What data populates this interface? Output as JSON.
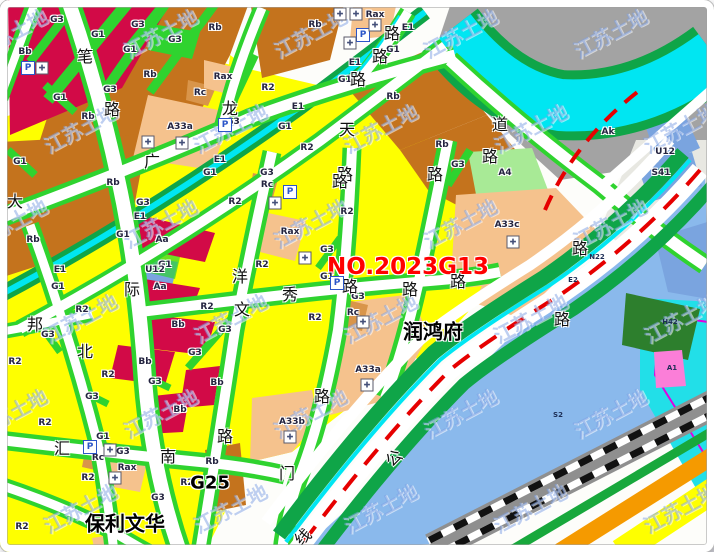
{
  "map": {
    "lot_label": {
      "text": "NO.2023G13",
      "x": 408,
      "y": 267,
      "color": "#ff0000"
    },
    "landmarks": [
      {
        "text": "润鸿府",
        "x": 433,
        "y": 330,
        "style": "poi"
      },
      {
        "text": "G25",
        "x": 210,
        "y": 483,
        "style": "poi-small"
      },
      {
        "text": "保利文华",
        "x": 125,
        "y": 522,
        "style": "poi"
      }
    ],
    "watermark": {
      "text": "江苏土地"
    },
    "street_chars": [
      {
        "t": "笔",
        "x": 85,
        "y": 55
      },
      {
        "t": "路",
        "x": 112,
        "y": 108
      },
      {
        "t": "广",
        "x": 152,
        "y": 160
      },
      {
        "t": "龙",
        "x": 230,
        "y": 107
      },
      {
        "t": "天",
        "x": 347,
        "y": 128
      },
      {
        "t": "道",
        "x": 500,
        "y": 123
      },
      {
        "t": "路",
        "x": 490,
        "y": 155
      },
      {
        "t": "路",
        "x": 392,
        "y": 32
      },
      {
        "t": "路",
        "x": 380,
        "y": 55
      },
      {
        "t": "路",
        "x": 358,
        "y": 78
      },
      {
        "t": "路",
        "x": 345,
        "y": 173
      },
      {
        "t": "路",
        "x": 435,
        "y": 173
      },
      {
        "t": "大",
        "x": 15,
        "y": 200
      },
      {
        "t": "际",
        "x": 132,
        "y": 288
      },
      {
        "t": "邦",
        "x": 35,
        "y": 323
      },
      {
        "t": "北",
        "x": 85,
        "y": 350
      },
      {
        "t": "洋",
        "x": 240,
        "y": 275
      },
      {
        "t": "文",
        "x": 242,
        "y": 308
      },
      {
        "t": "秀",
        "x": 290,
        "y": 293
      },
      {
        "t": "路",
        "x": 350,
        "y": 285
      },
      {
        "t": "路",
        "x": 410,
        "y": 288
      },
      {
        "t": "路",
        "x": 458,
        "y": 280
      },
      {
        "t": "路",
        "x": 340,
        "y": 180
      },
      {
        "t": "路",
        "x": 580,
        "y": 247
      },
      {
        "t": "路",
        "x": 562,
        "y": 318
      },
      {
        "t": "汇",
        "x": 62,
        "y": 447
      },
      {
        "t": "南",
        "x": 168,
        "y": 455
      },
      {
        "t": "路",
        "x": 225,
        "y": 435
      },
      {
        "t": "路",
        "x": 322,
        "y": 395
      },
      {
        "t": "门",
        "x": 287,
        "y": 472
      },
      {
        "t": "公",
        "x": 393,
        "y": 457,
        "r": 1
      },
      {
        "t": "线",
        "x": 302,
        "y": 536,
        "r": 1
      }
    ],
    "parcel_codes": [
      {
        "t": "G3",
        "x": 57,
        "y": 20
      },
      {
        "t": "G3",
        "x": 138,
        "y": 25
      },
      {
        "t": "Rb",
        "x": 215,
        "y": 28
      },
      {
        "t": "Bb",
        "x": 25,
        "y": 52
      },
      {
        "t": "G1",
        "x": 98,
        "y": 35
      },
      {
        "t": "G1",
        "x": 130,
        "y": 50
      },
      {
        "t": "G3",
        "x": 175,
        "y": 40
      },
      {
        "t": "Rb",
        "x": 150,
        "y": 75
      },
      {
        "t": "Rax",
        "x": 223,
        "y": 77
      },
      {
        "t": "Rc",
        "x": 200,
        "y": 93
      },
      {
        "t": "G1",
        "x": 60,
        "y": 98
      },
      {
        "t": "G3",
        "x": 110,
        "y": 90
      },
      {
        "t": "Rb",
        "x": 88,
        "y": 117
      },
      {
        "t": "A33a",
        "x": 180,
        "y": 127
      },
      {
        "t": "G3",
        "x": 233,
        "y": 122
      },
      {
        "t": "G1",
        "x": 20,
        "y": 162
      },
      {
        "t": "E1",
        "x": 220,
        "y": 160
      },
      {
        "t": "G1",
        "x": 210,
        "y": 173
      },
      {
        "t": "Rb",
        "x": 113,
        "y": 183
      },
      {
        "t": "Rb",
        "x": 315,
        "y": 25
      },
      {
        "t": "Rax",
        "x": 375,
        "y": 15
      },
      {
        "t": "E1",
        "x": 408,
        "y": 28
      },
      {
        "t": "G1",
        "x": 393,
        "y": 50
      },
      {
        "t": "E1",
        "x": 355,
        "y": 63
      },
      {
        "t": "G1",
        "x": 345,
        "y": 80
      },
      {
        "t": "R2",
        "x": 268,
        "y": 88
      },
      {
        "t": "Rb",
        "x": 393,
        "y": 97
      },
      {
        "t": "E1",
        "x": 298,
        "y": 107
      },
      {
        "t": "G1",
        "x": 285,
        "y": 127
      },
      {
        "t": "R2",
        "x": 307,
        "y": 148
      },
      {
        "t": "Rb",
        "x": 442,
        "y": 145
      },
      {
        "t": "G3",
        "x": 267,
        "y": 173
      },
      {
        "t": "Rc",
        "x": 267,
        "y": 185
      },
      {
        "t": "G3",
        "x": 458,
        "y": 165
      },
      {
        "t": "Ak",
        "x": 608,
        "y": 132
      },
      {
        "t": "A4",
        "x": 505,
        "y": 173
      },
      {
        "t": "U12",
        "x": 665,
        "y": 152
      },
      {
        "t": "S41",
        "x": 661,
        "y": 173
      },
      {
        "t": "G3",
        "x": 143,
        "y": 203
      },
      {
        "t": "E1",
        "x": 140,
        "y": 217
      },
      {
        "t": "G1",
        "x": 123,
        "y": 235
      },
      {
        "t": "Rb",
        "x": 33,
        "y": 240
      },
      {
        "t": "Aa",
        "x": 162,
        "y": 240
      },
      {
        "t": "E1",
        "x": 60,
        "y": 270
      },
      {
        "t": "G1",
        "x": 165,
        "y": 265
      },
      {
        "t": "U12",
        "x": 155,
        "y": 270
      },
      {
        "t": "G1",
        "x": 58,
        "y": 287
      },
      {
        "t": "Aa",
        "x": 160,
        "y": 287
      },
      {
        "t": "R2",
        "x": 235,
        "y": 202
      },
      {
        "t": "R2",
        "x": 82,
        "y": 310
      },
      {
        "t": "R2",
        "x": 207,
        "y": 307
      },
      {
        "t": "G3",
        "x": 48,
        "y": 335
      },
      {
        "t": "Bb",
        "x": 178,
        "y": 325
      },
      {
        "t": "G3",
        "x": 225,
        "y": 330
      },
      {
        "t": "R2",
        "x": 15,
        "y": 362
      },
      {
        "t": "G3",
        "x": 195,
        "y": 353
      },
      {
        "t": "Bb",
        "x": 145,
        "y": 362
      },
      {
        "t": "R2",
        "x": 108,
        "y": 375
      },
      {
        "t": "R2",
        "x": 347,
        "y": 212
      },
      {
        "t": "Rax",
        "x": 290,
        "y": 232
      },
      {
        "t": "G3",
        "x": 327,
        "y": 250
      },
      {
        "t": "R2",
        "x": 262,
        "y": 265
      },
      {
        "t": "G1",
        "x": 327,
        "y": 277
      },
      {
        "t": "G3",
        "x": 358,
        "y": 297
      },
      {
        "t": "Rc",
        "x": 353,
        "y": 313
      },
      {
        "t": "R2",
        "x": 315,
        "y": 318
      },
      {
        "t": "A33a",
        "x": 368,
        "y": 370
      },
      {
        "t": "A33c",
        "x": 507,
        "y": 225
      },
      {
        "t": "A33b",
        "x": 292,
        "y": 422
      },
      {
        "t": "G3",
        "x": 155,
        "y": 382
      },
      {
        "t": "Bb",
        "x": 217,
        "y": 383
      },
      {
        "t": "G3",
        "x": 92,
        "y": 397
      },
      {
        "t": "R2",
        "x": 45,
        "y": 423
      },
      {
        "t": "Bb",
        "x": 180,
        "y": 410
      },
      {
        "t": "G1",
        "x": 103,
        "y": 437
      },
      {
        "t": "Rc",
        "x": 98,
        "y": 458
      },
      {
        "t": "G3",
        "x": 123,
        "y": 452
      },
      {
        "t": "Rb",
        "x": 212,
        "y": 462
      },
      {
        "t": "Rax",
        "x": 127,
        "y": 468
      },
      {
        "t": "R2",
        "x": 88,
        "y": 478
      },
      {
        "t": "R2",
        "x": 187,
        "y": 483
      },
      {
        "t": "R2",
        "x": 22,
        "y": 527
      },
      {
        "t": "G3",
        "x": 158,
        "y": 498
      },
      {
        "t": "H42",
        "x": 670,
        "y": 322,
        "s": 1
      },
      {
        "t": "A1",
        "x": 672,
        "y": 368,
        "s": 1
      },
      {
        "t": "N22",
        "x": 597,
        "y": 257,
        "s": 1
      },
      {
        "t": "E2",
        "x": 573,
        "y": 280,
        "s": 1
      },
      {
        "t": "S2",
        "x": 558,
        "y": 415,
        "s": 1
      }
    ],
    "icons": [
      {
        "k": "parking",
        "g": "P",
        "x": 28,
        "y": 68
      },
      {
        "k": "parking",
        "g": "P",
        "x": 363,
        "y": 35
      },
      {
        "k": "parking",
        "g": "P",
        "x": 290,
        "y": 192
      },
      {
        "k": "parking",
        "g": "P",
        "x": 337,
        "y": 283
      },
      {
        "k": "parking",
        "g": "P",
        "x": 90,
        "y": 447
      },
      {
        "k": "parking",
        "g": "P",
        "x": 225,
        "y": 125
      },
      {
        "k": "facility",
        "g": "✚",
        "x": 42,
        "y": 68
      },
      {
        "k": "facility",
        "g": "✚",
        "x": 375,
        "y": 25
      },
      {
        "k": "facility",
        "g": "✚",
        "x": 350,
        "y": 43
      },
      {
        "k": "facility",
        "g": "✚",
        "x": 182,
        "y": 143
      },
      {
        "k": "facility",
        "g": "✚",
        "x": 275,
        "y": 203
      },
      {
        "k": "facility",
        "g": "✚",
        "x": 305,
        "y": 258
      },
      {
        "k": "facility",
        "g": "✚",
        "x": 363,
        "y": 322
      },
      {
        "k": "facility",
        "g": "✚",
        "x": 513,
        "y": 242
      },
      {
        "k": "facility",
        "g": "✚",
        "x": 367,
        "y": 385
      },
      {
        "k": "facility",
        "g": "✚",
        "x": 290,
        "y": 437
      },
      {
        "k": "facility",
        "g": "✚",
        "x": 110,
        "y": 450
      },
      {
        "k": "facility",
        "g": "✚",
        "x": 115,
        "y": 478
      },
      {
        "k": "facility",
        "g": "✚",
        "x": 148,
        "y": 142
      },
      {
        "k": "facility",
        "g": "✚",
        "x": 340,
        "y": 14
      },
      {
        "k": "facility",
        "g": "✚",
        "x": 356,
        "y": 14
      }
    ],
    "colors": {
      "residential_R2": "#feff00",
      "residential_Rb": "#c4731d",
      "residential_Rax": "#f5c28d",
      "admin_Aa_Bb": "#d20a47",
      "green_space": "#2fd32f",
      "park_bank": "#0fa548",
      "water_E1": "#00e6f2",
      "river_water": "#8ab9ec",
      "village_Ak": "#a3a3a3",
      "utility_U12": "#7aa4df",
      "A4": "#a8ea96",
      "metro_line": "#e60000"
    }
  }
}
